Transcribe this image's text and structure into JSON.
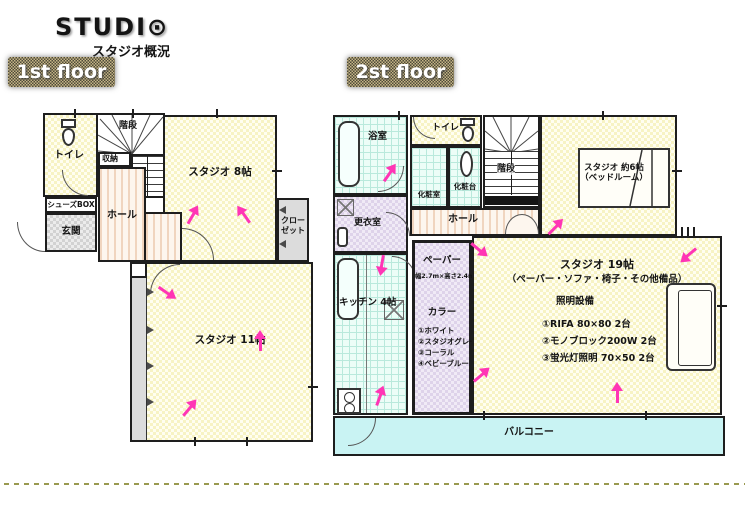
{
  "header": {
    "logo_prefix": "STUDI",
    "logo_o": "⊙",
    "subtitle": "スタジオ概況"
  },
  "colors": {
    "accent_pink": "#ff35b5",
    "room_yellow": "#fffef0",
    "tile_cyan": "#ecfdf7",
    "lavender": "#f0eaf6",
    "balcony_cyan": "#c9f3f3",
    "tag_tan": "#c7b687"
  },
  "floor1": {
    "tag": "1st floor",
    "rooms": {
      "toilet": "トイレ",
      "stairs": "階段",
      "storage": "収納",
      "shoes_box": "シューズBOX",
      "entrance": "玄関",
      "hall": "ホール",
      "studio8": "スタジオ 8帖",
      "closet_l1": "クロー",
      "closet_l2": "ゼット",
      "studio11": "スタジオ 11帖"
    }
  },
  "floor2": {
    "tag": "2st floor",
    "rooms": {
      "bath": "浴室",
      "toilet": "トイレ",
      "powder_room": "化粧室",
      "vanity": "化粧台",
      "stairs": "階段",
      "studio6_l1": "スタジオ 約6帖",
      "studio6_l2": "（ベッドルーム）",
      "changing_room": "更衣室",
      "hall": "ホール",
      "kitchen": "キッチン 4帖",
      "balcony": "バルコニー"
    },
    "paper": {
      "title": "ペーパー",
      "size": "幅2.7m×高さ2.4m",
      "color_title": "カラー",
      "colors": [
        "①ホワイト",
        "②スタジオグレー",
        "③コーラル",
        "④ベビーブルー"
      ]
    },
    "studio19": {
      "title": "スタジオ 19帖",
      "subtitle": "（ペーパー・ソファ・椅子・その他備品）",
      "lighting_title": "照明設備",
      "lighting": [
        "①RIFA 80×80 2台",
        "②モノブロック200W 2台",
        "③蛍光灯照明 70×50 2台"
      ]
    }
  }
}
